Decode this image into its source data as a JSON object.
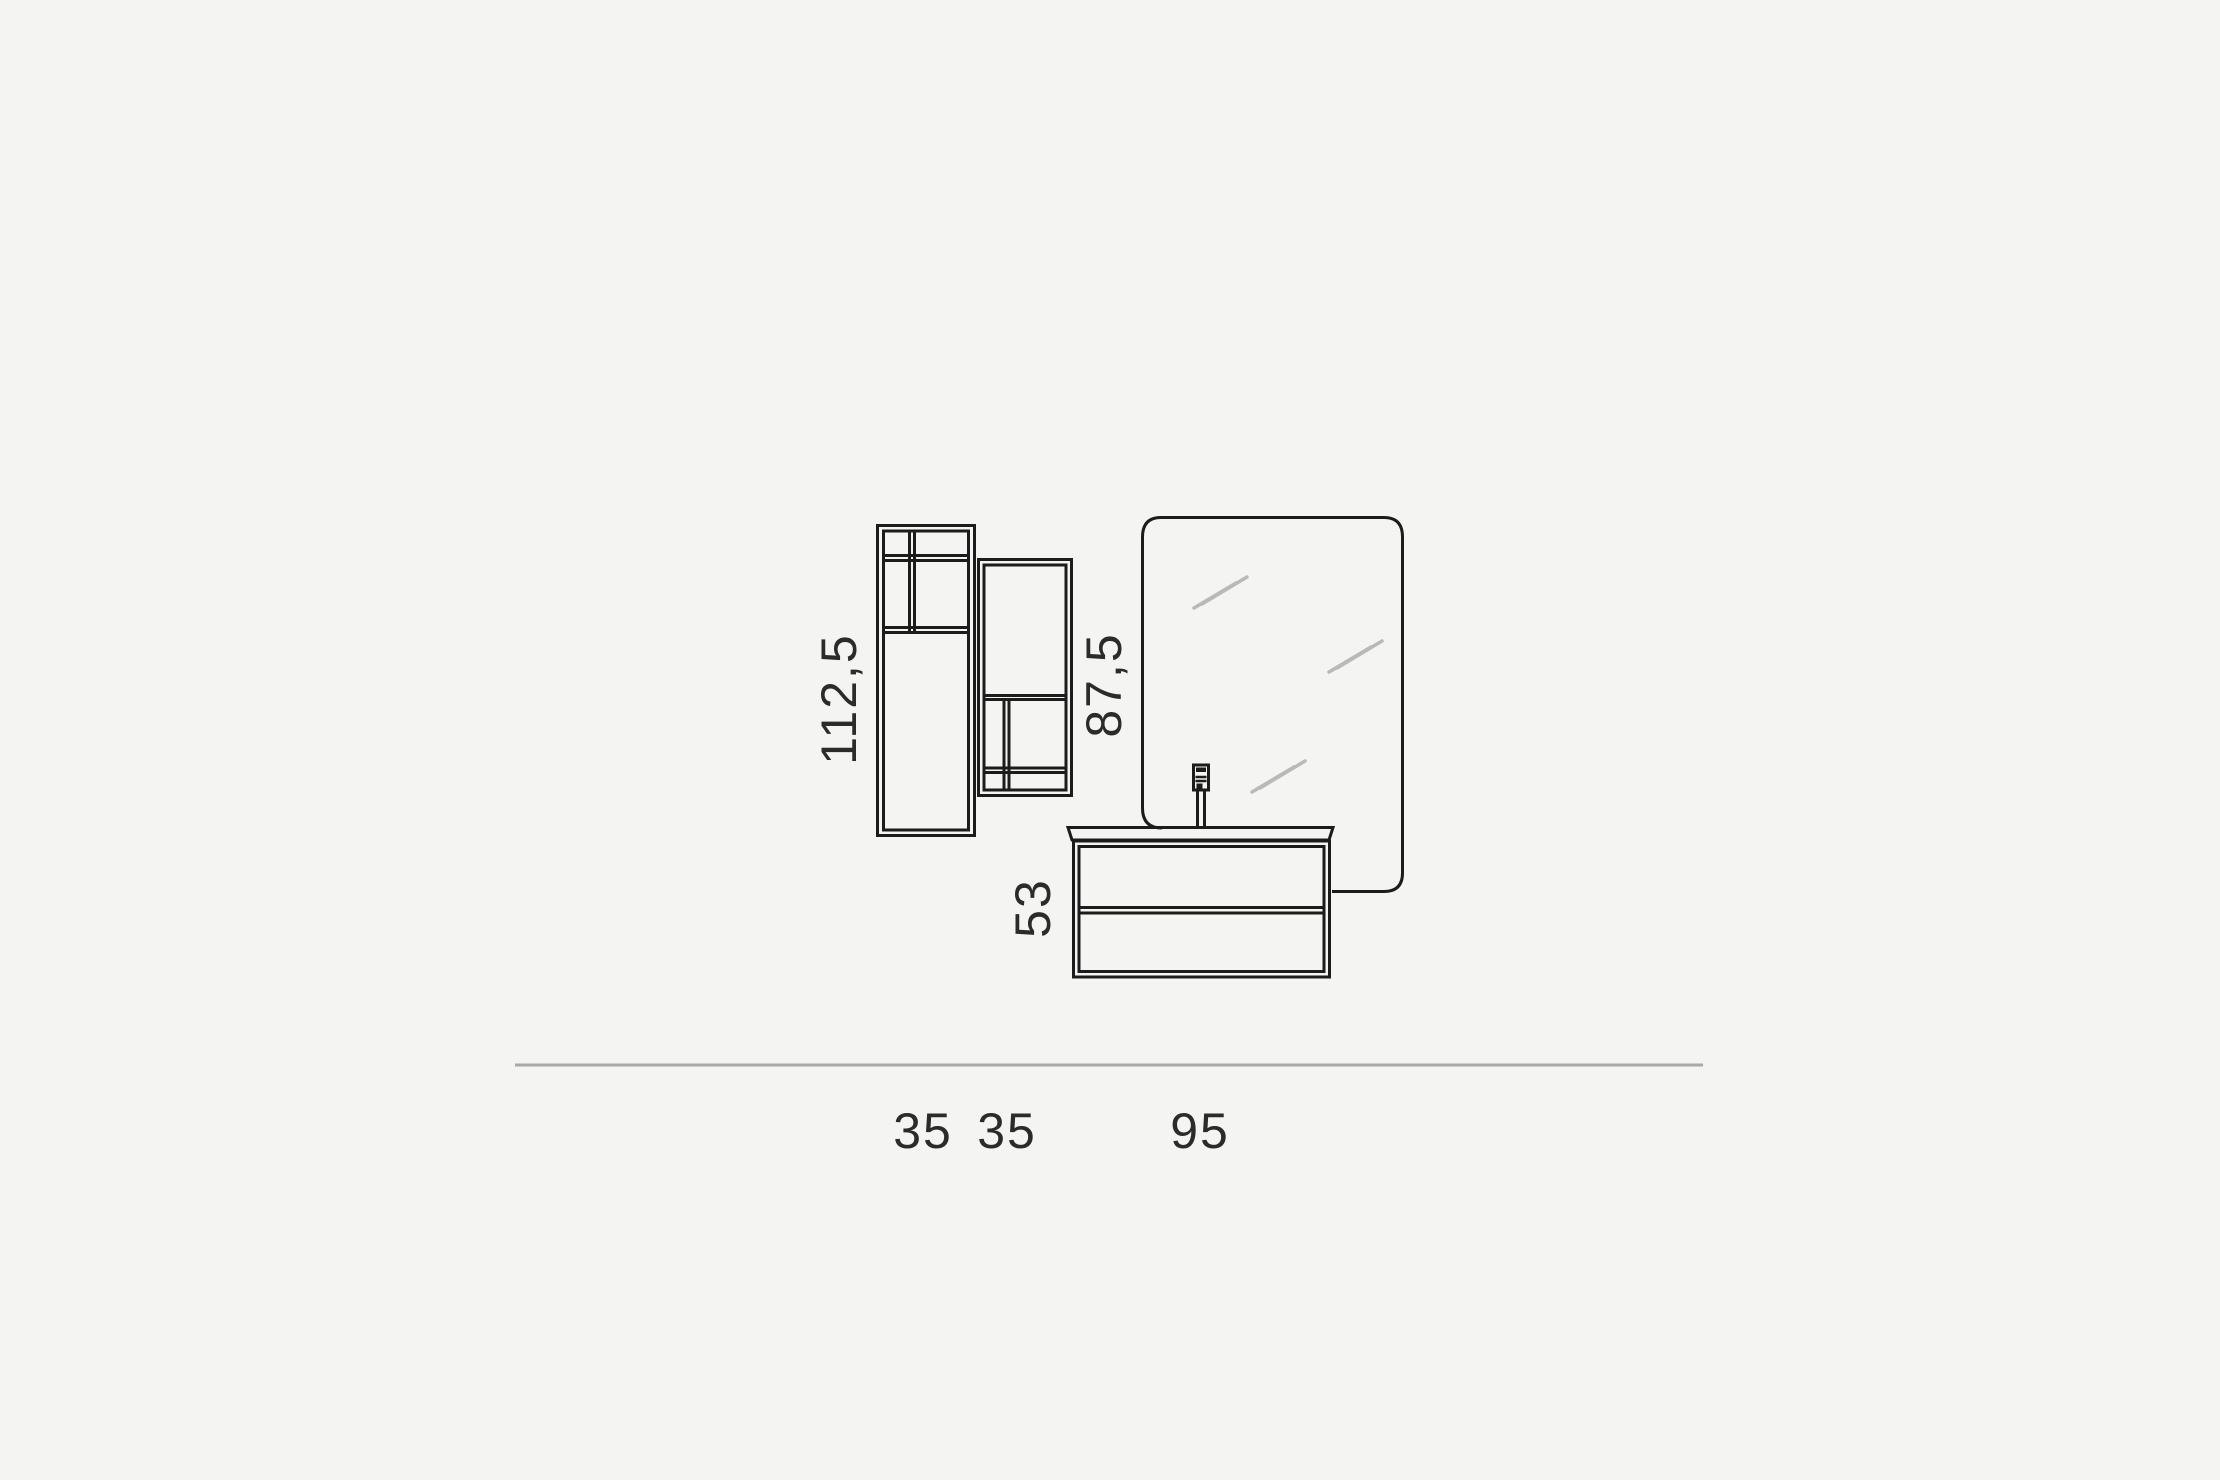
{
  "diagram": {
    "type": "bathroom-furniture-dimension-drawing",
    "labels": {
      "tall_cabinet_height": "112,5",
      "wall_cabinet_height": "87,5",
      "vanity_height": "53",
      "tall_cabinet_width": "35",
      "wall_cabinet_width": "35",
      "vanity_width": "95"
    },
    "colors": {
      "background": "#f4f4f2",
      "outline": "#1c1c1c",
      "mirror_gleam": "#b9b9b9",
      "baseline": "#a9a9a9",
      "text": "#2b2b2b"
    }
  }
}
